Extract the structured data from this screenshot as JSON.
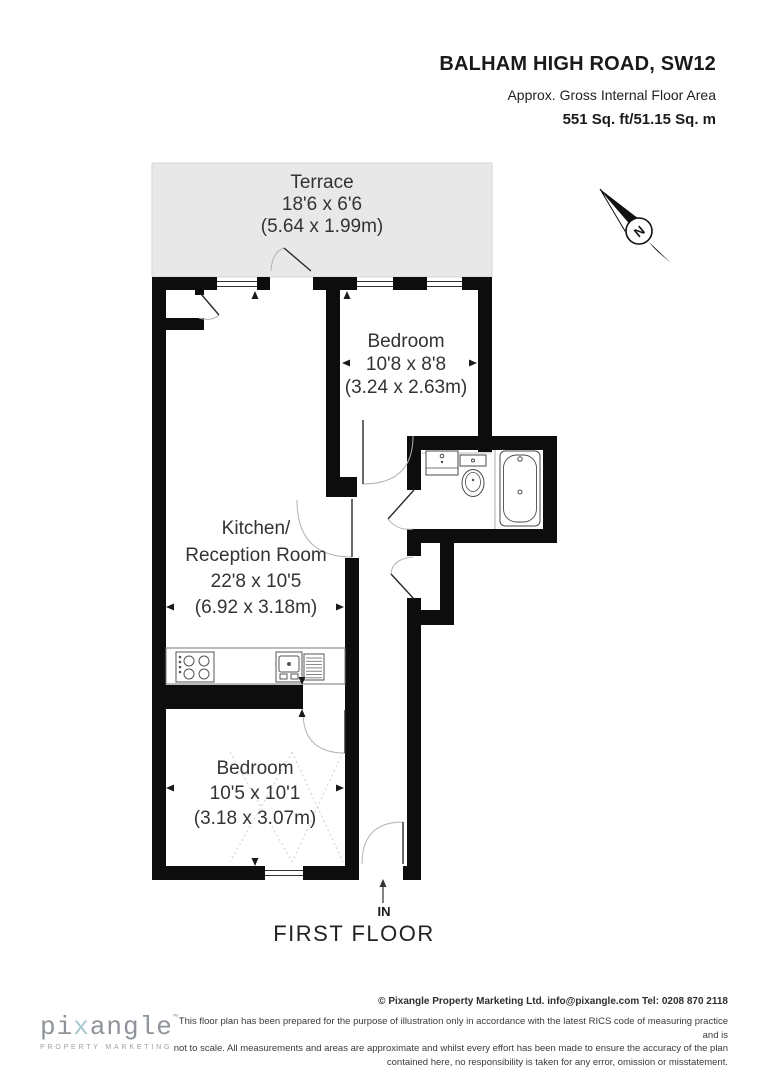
{
  "header": {
    "title": "BALHAM HIGH ROAD, SW12",
    "subtitle": "Approx. Gross Internal Floor Area",
    "area": "551 Sq. ft/51.15 Sq. m"
  },
  "plan": {
    "terrace": {
      "name": "Terrace",
      "imperial": "18'6 x 6'6",
      "metric": "(5.64 x 1.99m)"
    },
    "bedroom1": {
      "name": "Bedroom",
      "imperial": "10'8 x 8'8",
      "metric": "(3.24 x 2.63m)"
    },
    "kitchen": {
      "line1": "Kitchen/",
      "line2": "Reception Room",
      "imperial": "22'8 x 10'5",
      "metric": "(6.92 x 3.18m)"
    },
    "bedroom2": {
      "name": "Bedroom",
      "imperial": "10'5 x 10'1",
      "metric": "(3.18 x 3.07m)"
    },
    "compass_n": "N",
    "in_label": "IN",
    "floor_label": "FIRST FLOOR"
  },
  "footer": {
    "copyright": "© Pixangle Property Marketing Ltd. info@pixangle.com Tel: 0208 870 2118",
    "disclaimer_line1": "This floor plan has been prepared for the purpose of illustration only in accordance with the latest RICS code of measuring practice and is",
    "disclaimer_line2": "not to scale. All measurements and areas are approximate and whilst every effort has been made to ensure the accuracy of the plan",
    "disclaimer_line3": "contained here, no responsibility is taken for any error, omission or misstatement."
  },
  "logo": {
    "name_pre": "pi",
    "name_x": "x",
    "name_post": "angle",
    "tm": "™",
    "tagline": "PROPERTY MARKETING"
  },
  "colors": {
    "wall": "#0d0d0d",
    "terrace_fill": "#e8e8e8",
    "label_text": "#333333",
    "logo_text": "#8e9499",
    "logo_x": "#a9c7ce"
  }
}
